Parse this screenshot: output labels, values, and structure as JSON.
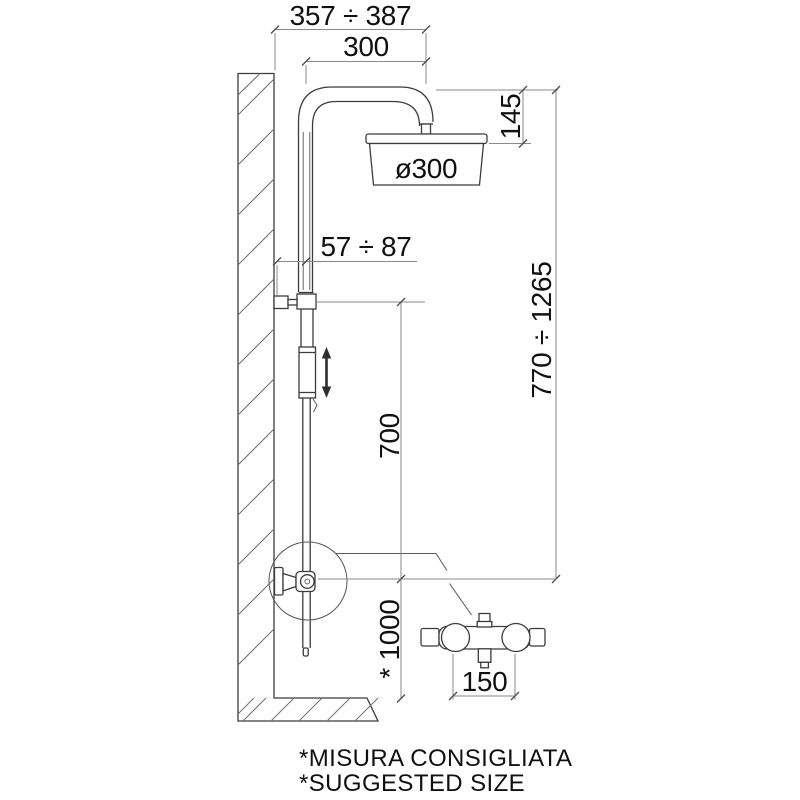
{
  "drawing": {
    "type": "technical-dimension-drawing",
    "subject": "wall-mounted shower column with overhead head, sliding hand shower and external mixer",
    "labels": {
      "width_range": "357 ÷ 387",
      "arm_projection": "300",
      "head_height": "145",
      "head_diameter": "ø300",
      "wall_clearance": "57 ÷ 87",
      "column_height": "770 ÷ 1265",
      "slide_travel": "700",
      "mixer_height": "* 1000",
      "inlet_spacing": "150"
    },
    "footnotes": {
      "line1": "*MISURA CONSIGLIATA",
      "line2": "*SUGGESTED SIZE"
    },
    "colors": {
      "background": "#ffffff",
      "geometry_line": "#3c3c3c",
      "dimension_line": "#8a8a8a",
      "text": "#101010"
    }
  }
}
